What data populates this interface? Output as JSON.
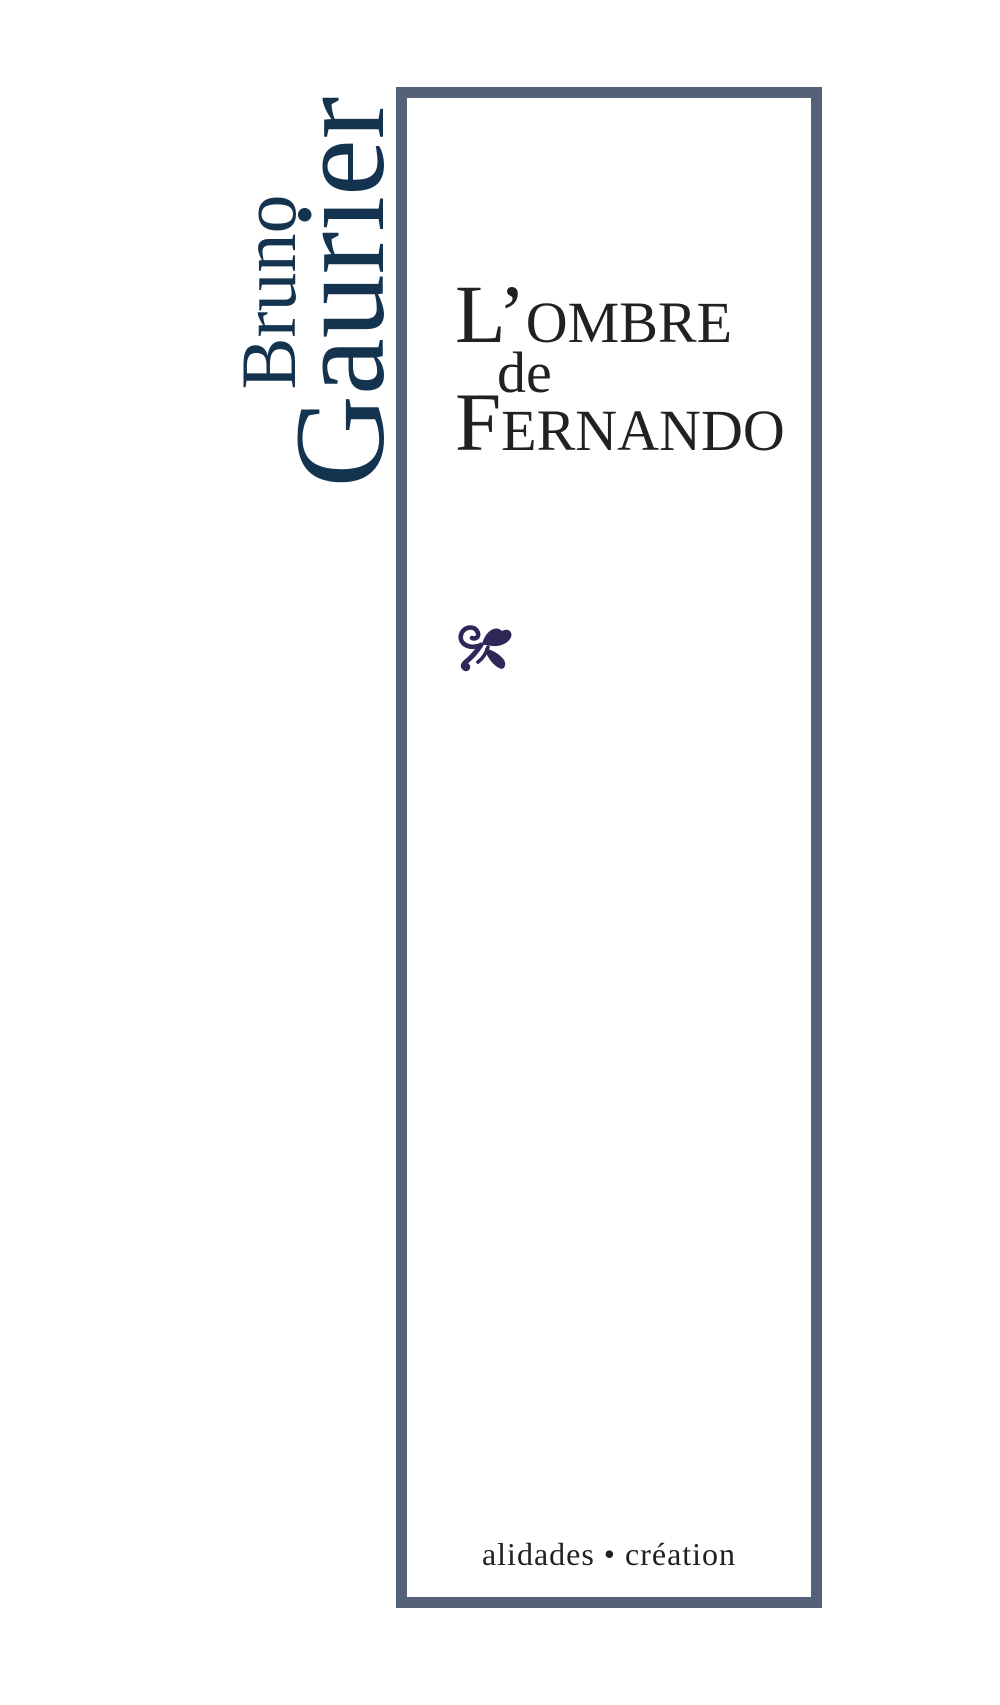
{
  "page": {
    "background_color": "#ffffff",
    "kind": "book cover"
  },
  "author": {
    "line1": "Bruno",
    "line2": "Gaurier",
    "color": "#14334f",
    "orientation": "rotated-90-ccw"
  },
  "frame": {
    "border_color": "#546179",
    "fill_color": "#ffffff"
  },
  "title": {
    "full_text": "L’ombre de Fernando",
    "line1_initial": "L’",
    "line1_small_caps": "OMBRE",
    "line2": "de",
    "line3_initial": "F",
    "line3_small_caps": "ERNANDO",
    "color": "#232120"
  },
  "ornament": {
    "name": "fleuron",
    "color": "#2d2858"
  },
  "publisher": {
    "label": "alidades • création",
    "color": "#232120"
  }
}
